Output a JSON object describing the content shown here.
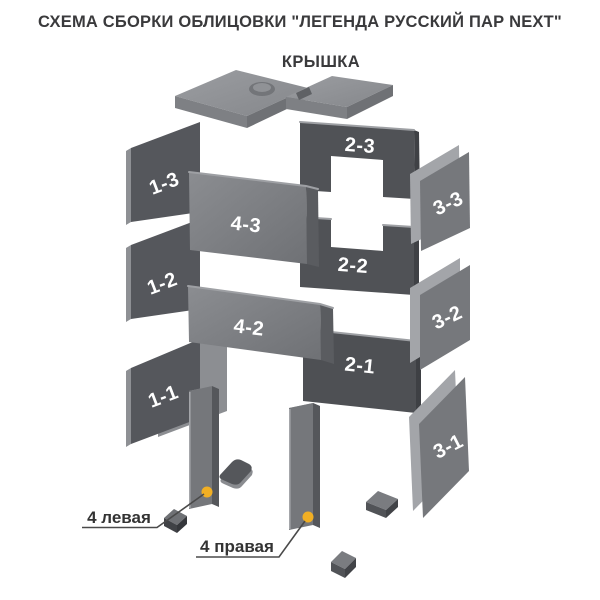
{
  "header": {
    "title": "СХЕМА СБОРКИ ОБЛИЦОВКИ  \"ЛЕГЕНДА РУССКИЙ ПАР NEXT\""
  },
  "diagram": {
    "lid": {
      "label": "КРЫШКА"
    },
    "parts": {
      "p13": "1-3",
      "p12": "1-2",
      "p11": "1-1",
      "p23": "2-3",
      "p22": "2-2",
      "p21": "2-1",
      "p33": "3-3",
      "p32": "3-2",
      "p31": "3-1",
      "p43": "4-3",
      "p42": "4-2"
    },
    "callouts": {
      "left_post": "4 левая",
      "right_post": "4 правая"
    },
    "colors": {
      "background": "#ffffff",
      "panel_dark": "#53555a",
      "panel_mid": "#76787c",
      "panel_light": "#9a9ca0",
      "accent_dot": "#f1af24",
      "text_dark": "#333333",
      "label_on_panel": "#ffffff"
    }
  }
}
